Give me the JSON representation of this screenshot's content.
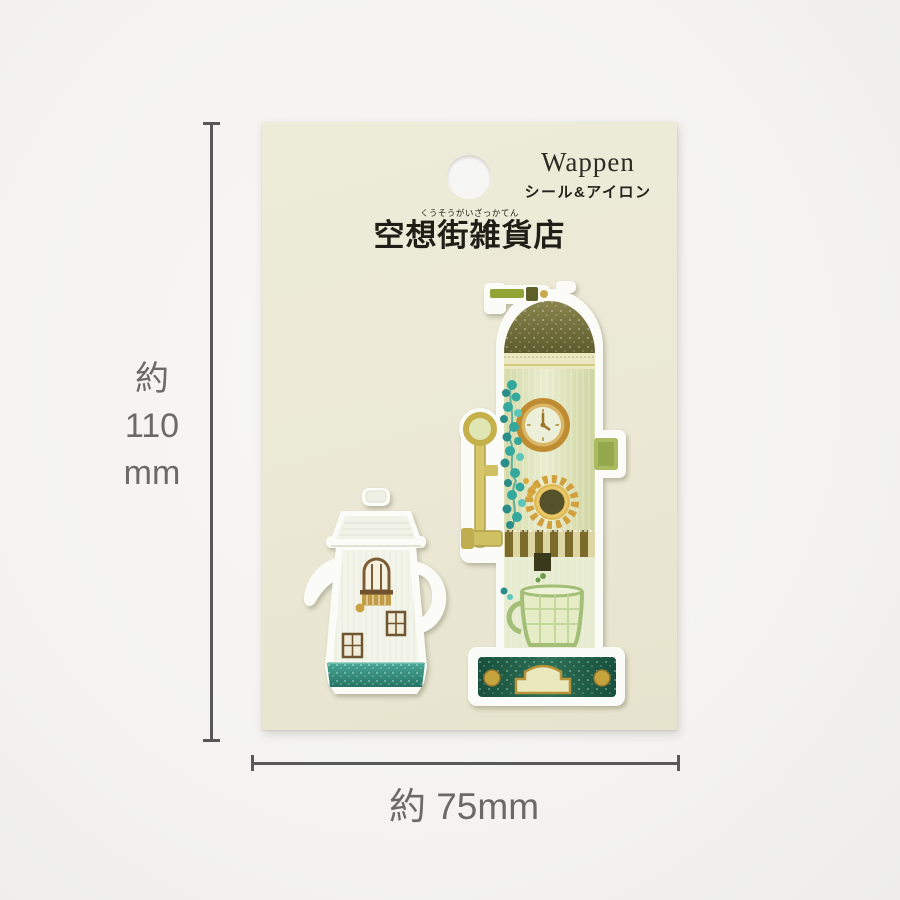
{
  "card": {
    "title": "Wappen",
    "subtitle": "シール&アイロン",
    "brand_furigana": "くうそうがいざっかてん",
    "brand_name": "空想街雑貨店"
  },
  "dimensions": {
    "height": [
      "約",
      "110",
      "mm"
    ],
    "width": "約 75mm"
  },
  "patches": {
    "left": {
      "icon": "teapot-house-patch"
    },
    "right": {
      "icon": "clock-tower-patch"
    }
  },
  "colors": {
    "card_color": "#ebe9d5",
    "backdrop_color": "#f4f3f1",
    "dimension_line_color": "#58585a",
    "dimension_text_color": "#6a6a6a",
    "card_text_color": "#23231c",
    "patch_white": "#fbfbf7",
    "teal_base": "#359483",
    "dome_olive": "#6d6a35",
    "gold": "#c49a3f",
    "base_dark_green": "#1d5a44"
  }
}
